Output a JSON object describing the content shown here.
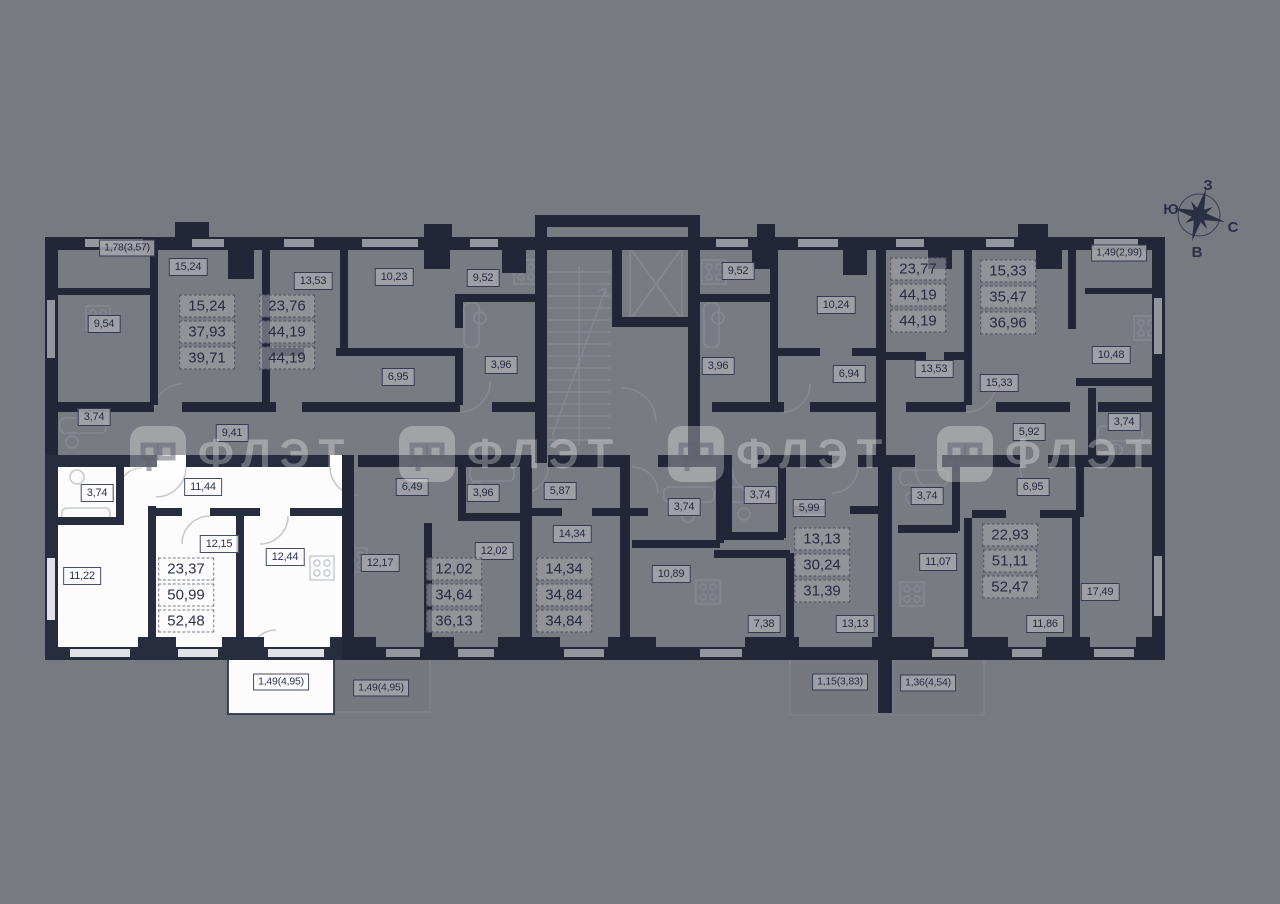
{
  "page_title": "Floor plan with selected apartment",
  "colors": {
    "background": "#7a7b7e",
    "walls": "#272c3e",
    "selected_fill": "#fcfcfd",
    "label_text": "#2d3350",
    "watermark": "rgba(255,255,255,0.30)"
  },
  "selected_apartment": {
    "residential_area": "23,37",
    "total_area": "50,99",
    "area_with_balcony": "52,48",
    "rooms": [
      "3,74",
      "11,44",
      "11,22",
      "12,15",
      "12,44"
    ],
    "balcony": "1,49(4,95)"
  },
  "labels": [
    {
      "text": "1,78(3,57)",
      "x": 127,
      "y": 248,
      "kind": "balcony",
      "selected": false
    },
    {
      "text": "15,24",
      "x": 188,
      "y": 267,
      "kind": "room",
      "selected": false
    },
    {
      "text": "9,54",
      "x": 104,
      "y": 324,
      "kind": "room",
      "selected": false
    },
    {
      "text": "13,53",
      "x": 313,
      "y": 281,
      "kind": "room",
      "selected": false
    },
    {
      "text": "10,23",
      "x": 394,
      "y": 277,
      "kind": "room",
      "selected": false
    },
    {
      "text": "9,52",
      "x": 483,
      "y": 278,
      "kind": "room",
      "selected": false
    },
    {
      "text": "6,95",
      "x": 398,
      "y": 377,
      "kind": "room",
      "selected": false
    },
    {
      "text": "3,96",
      "x": 501,
      "y": 365,
      "kind": "room",
      "selected": false
    },
    {
      "text": "3,74",
      "x": 94,
      "y": 417,
      "kind": "room",
      "selected": false
    },
    {
      "text": "9,41",
      "x": 232,
      "y": 433,
      "kind": "room",
      "selected": false
    },
    {
      "text": "9,52",
      "x": 738,
      "y": 271,
      "kind": "room",
      "selected": false
    },
    {
      "text": "10,24",
      "x": 836,
      "y": 305,
      "kind": "room",
      "selected": false
    },
    {
      "text": "3,96",
      "x": 718,
      "y": 366,
      "kind": "room",
      "selected": false
    },
    {
      "text": "6,94",
      "x": 849,
      "y": 374,
      "kind": "room",
      "selected": false
    },
    {
      "text": "13,53",
      "x": 934,
      "y": 369,
      "kind": "room",
      "selected": false
    },
    {
      "text": "1,49(2,99)",
      "x": 1119,
      "y": 253,
      "kind": "balcony",
      "selected": false
    },
    {
      "text": "10,48",
      "x": 1111,
      "y": 355,
      "kind": "room",
      "selected": false
    },
    {
      "text": "15,33",
      "x": 999,
      "y": 383,
      "kind": "room",
      "selected": false
    },
    {
      "text": "5,92",
      "x": 1029,
      "y": 432,
      "kind": "room",
      "selected": false
    },
    {
      "text": "3,74",
      "x": 1124,
      "y": 422,
      "kind": "room",
      "selected": false
    },
    {
      "text": "3,74",
      "x": 97,
      "y": 493,
      "kind": "room",
      "selected": true
    },
    {
      "text": "11,44",
      "x": 203,
      "y": 487,
      "kind": "room",
      "selected": true
    },
    {
      "text": "11,22",
      "x": 82,
      "y": 576,
      "kind": "room",
      "selected": true
    },
    {
      "text": "12,15",
      "x": 219,
      "y": 544,
      "kind": "room",
      "selected": true
    },
    {
      "text": "12,44",
      "x": 285,
      "y": 557,
      "kind": "room",
      "selected": true
    },
    {
      "text": "1,49(4,95)",
      "x": 281,
      "y": 682,
      "kind": "balcony",
      "selected": true
    },
    {
      "text": "6,49",
      "x": 412,
      "y": 487,
      "kind": "room",
      "selected": false
    },
    {
      "text": "3,96",
      "x": 483,
      "y": 493,
      "kind": "room",
      "selected": false
    },
    {
      "text": "12,17",
      "x": 380,
      "y": 563,
      "kind": "room",
      "selected": false
    },
    {
      "text": "12,02",
      "x": 494,
      "y": 551,
      "kind": "room",
      "selected": false
    },
    {
      "text": "5,87",
      "x": 560,
      "y": 491,
      "kind": "room",
      "selected": false
    },
    {
      "text": "14,34",
      "x": 572,
      "y": 534,
      "kind": "room",
      "selected": false
    },
    {
      "text": "1,49(4,95)",
      "x": 381,
      "y": 688,
      "kind": "balcony",
      "selected": false
    },
    {
      "text": "3,74",
      "x": 684,
      "y": 507,
      "kind": "room",
      "selected": false
    },
    {
      "text": "10,89",
      "x": 671,
      "y": 574,
      "kind": "room",
      "selected": false
    },
    {
      "text": "3,74",
      "x": 760,
      "y": 495,
      "kind": "room",
      "selected": false
    },
    {
      "text": "5,99",
      "x": 809,
      "y": 508,
      "kind": "room",
      "selected": false
    },
    {
      "text": "7,38",
      "x": 764,
      "y": 624,
      "kind": "room",
      "selected": false
    },
    {
      "text": "13,13",
      "x": 855,
      "y": 624,
      "kind": "room",
      "selected": false
    },
    {
      "text": "1,15(3,83)",
      "x": 840,
      "y": 682,
      "kind": "balcony",
      "selected": false
    },
    {
      "text": "1,36(4,54)",
      "x": 928,
      "y": 683,
      "kind": "balcony",
      "selected": false
    },
    {
      "text": "3,74",
      "x": 927,
      "y": 496,
      "kind": "room",
      "selected": false
    },
    {
      "text": "11,07",
      "x": 938,
      "y": 562,
      "kind": "room",
      "selected": false
    },
    {
      "text": "6,95",
      "x": 1033,
      "y": 487,
      "kind": "room",
      "selected": false
    },
    {
      "text": "17,49",
      "x": 1100,
      "y": 592,
      "kind": "room",
      "selected": false
    },
    {
      "text": "11,86",
      "x": 1045,
      "y": 624,
      "kind": "room",
      "selected": false
    }
  ],
  "info_boxes": [
    {
      "x": 207,
      "y": 332,
      "lines": [
        "15,24",
        "37,93",
        "39,71"
      ],
      "selected": false
    },
    {
      "x": 287,
      "y": 332,
      "lines": [
        "23,76",
        "44,19",
        "44,19"
      ],
      "selected": false
    },
    {
      "x": 918,
      "y": 295,
      "lines": [
        "23,77",
        "44,19",
        "44,19"
      ],
      "selected": false
    },
    {
      "x": 1008,
      "y": 297,
      "lines": [
        "15,33",
        "35,47",
        "36,96"
      ],
      "selected": false
    },
    {
      "x": 186,
      "y": 595,
      "lines": [
        "23,37",
        "50,99",
        "52,48"
      ],
      "selected": true
    },
    {
      "x": 454,
      "y": 595,
      "lines": [
        "12,02",
        "34,64",
        "36,13"
      ],
      "selected": false
    },
    {
      "x": 564,
      "y": 595,
      "lines": [
        "14,34",
        "34,84",
        "34,84"
      ],
      "selected": false
    },
    {
      "x": 822,
      "y": 565,
      "lines": [
        "13,13",
        "30,24",
        "31,39"
      ],
      "selected": false
    },
    {
      "x": 1010,
      "y": 561,
      "lines": [
        "22,93",
        "51,11",
        "52,47"
      ],
      "selected": false
    }
  ],
  "watermark": {
    "text": "ФЛЭТ",
    "positions_x": [
      130,
      399,
      668,
      937
    ],
    "y": 426
  },
  "compass": {
    "top": "З",
    "left": "Ю",
    "right": "С",
    "bottom": "В"
  }
}
